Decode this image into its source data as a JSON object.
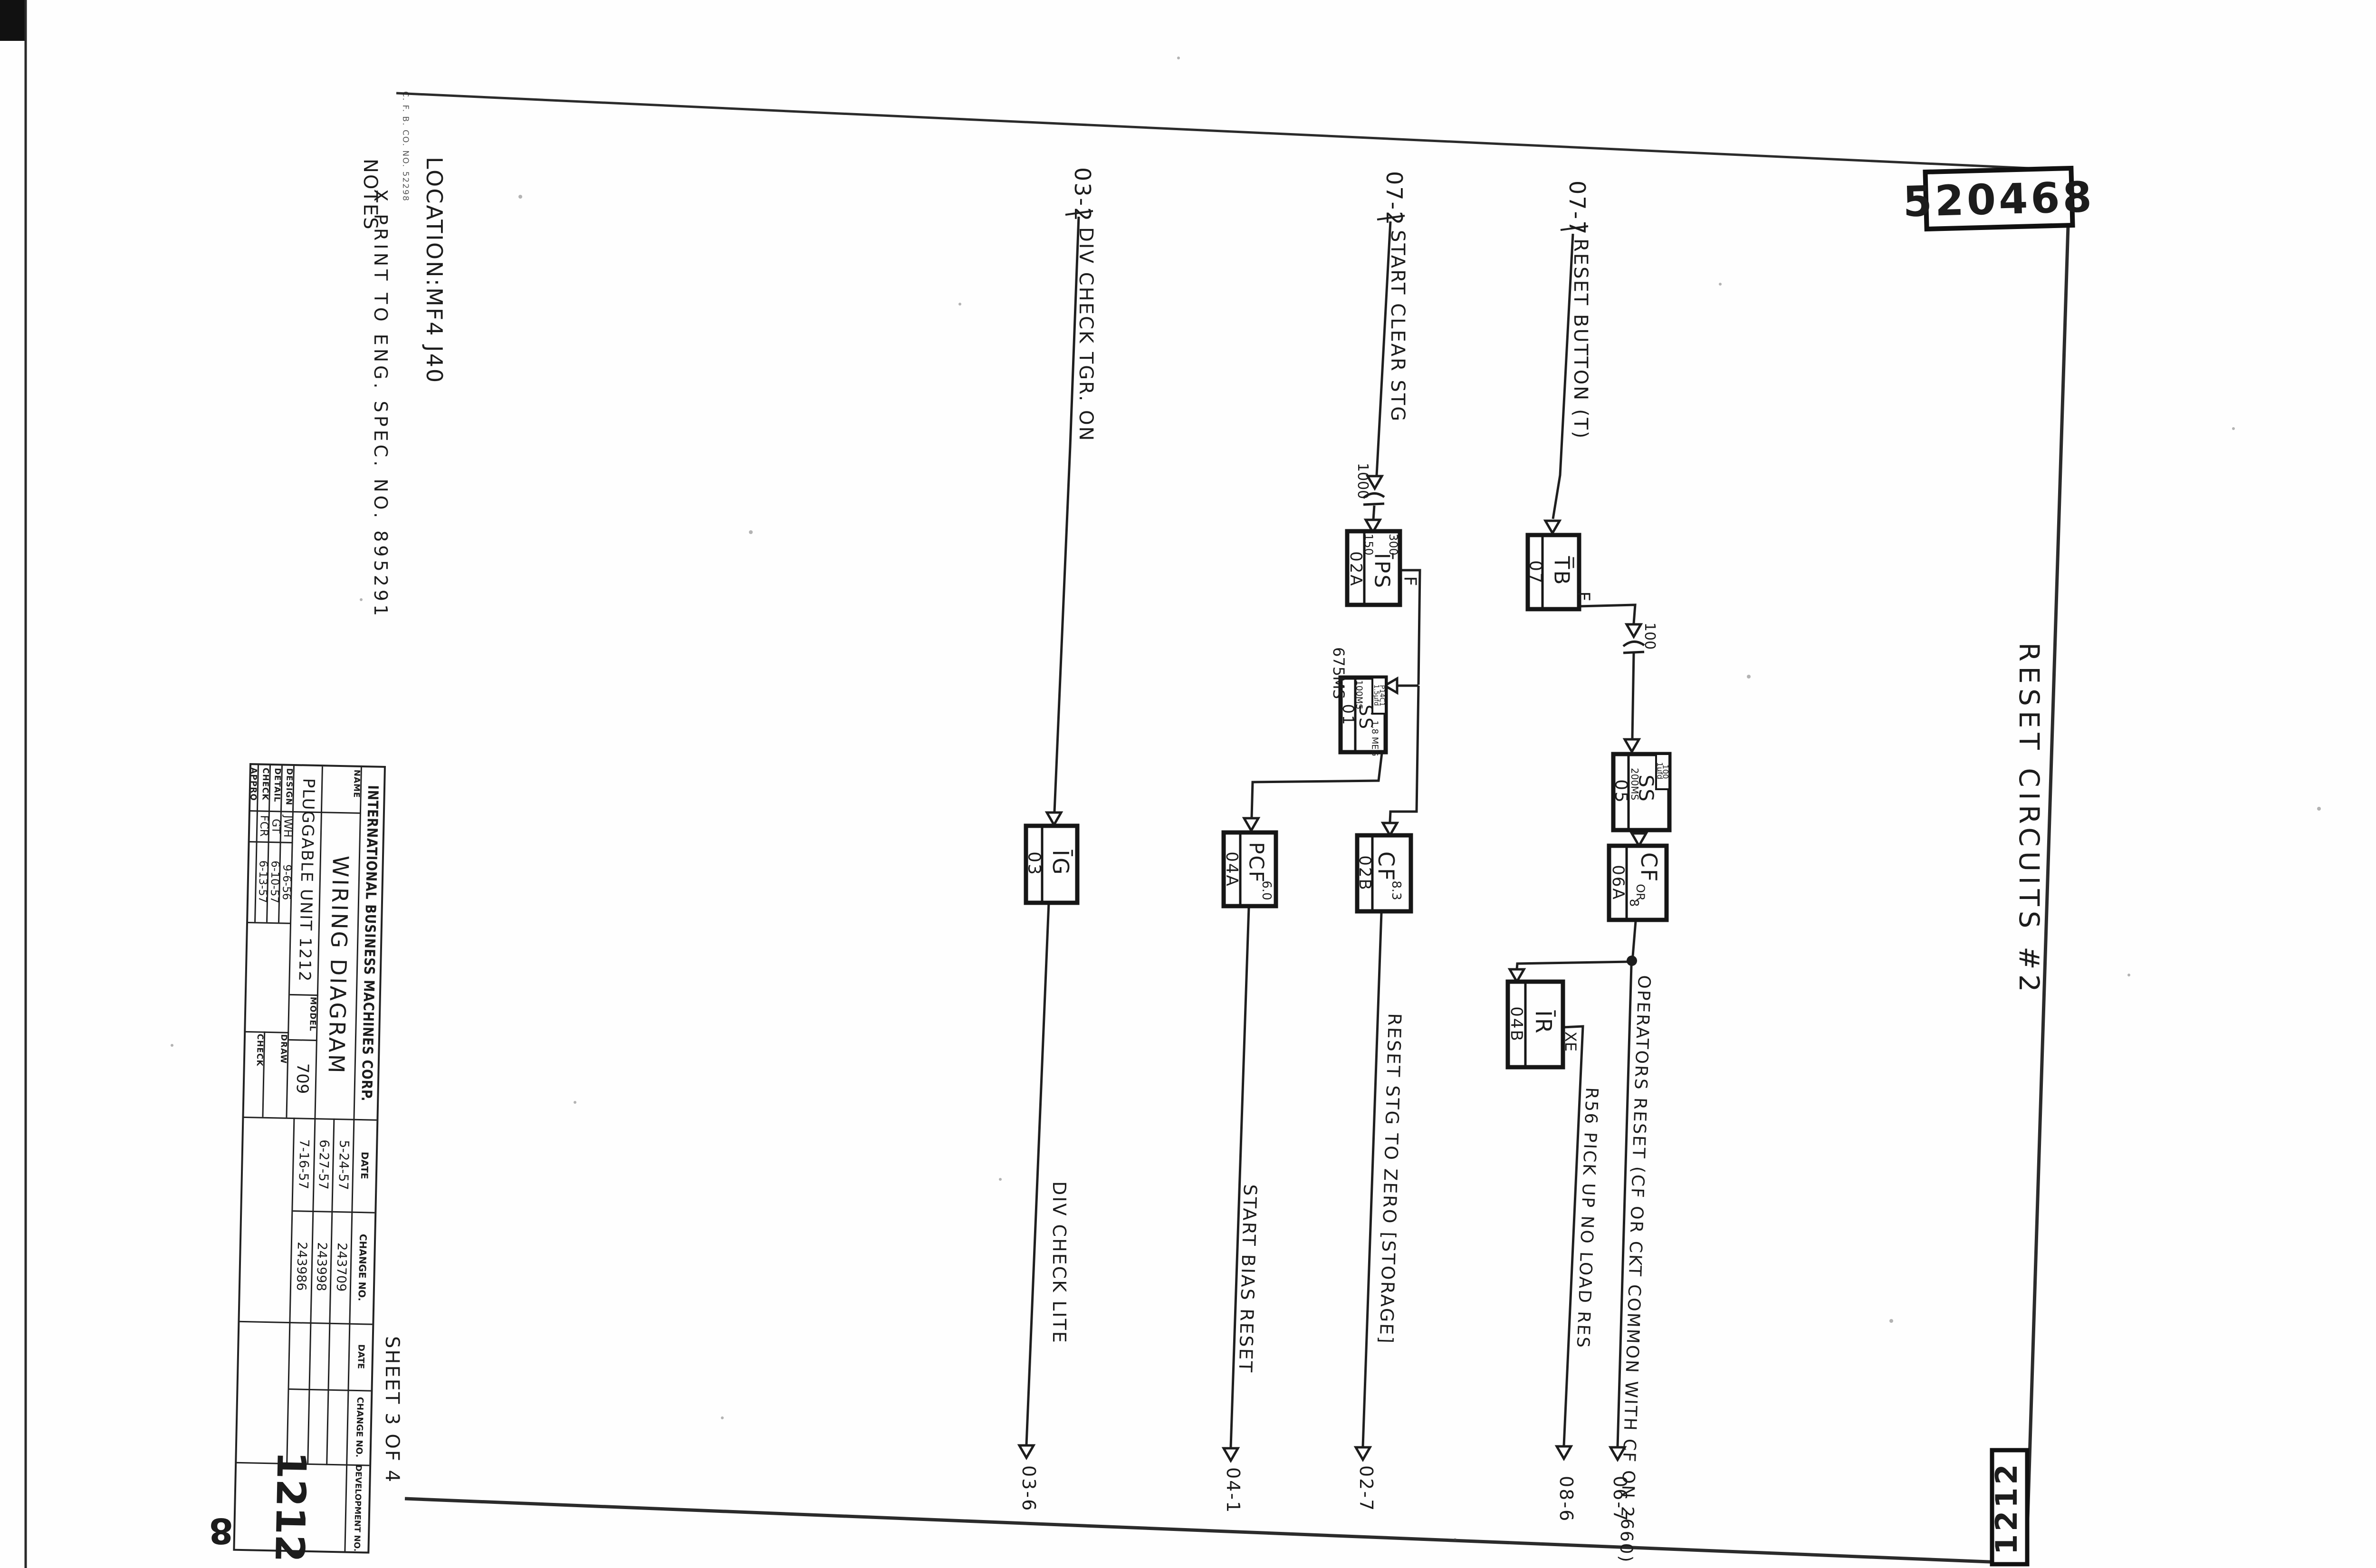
{
  "colors": {
    "ink": "#1c1c1c",
    "paper": "#fefefe"
  },
  "corner": {
    "drawing_no_top": "520468",
    "drawing_no_side": "520468",
    "unit_box": "1212"
  },
  "header": {
    "title": "RESET  CIRCUITS  #2",
    "location": "LOCATION:MF4 J40",
    "notes_heading": "NOTES",
    "note": "X  PRINT TO ENG. SPEC. NO. 895291",
    "fine_print": "C. F. B. CO. NO. 52298",
    "sheet": "SHEET 3 OF 4"
  },
  "title_block": {
    "company": "INTERNATIONAL BUSINESS MACHINES CORP.",
    "name_label": "NAME",
    "name_line1": "WIRING DIAGRAM",
    "name_line2": "PLUGGABLE UNIT 1212",
    "model_label": "MODEL",
    "model_value": "709",
    "rows": [
      {
        "label": "DESIGN",
        "initials": "JWH",
        "date": "9-6-56"
      },
      {
        "label": "DETAIL",
        "initials": "GT",
        "date": "6-10-57"
      },
      {
        "label": "CHECK",
        "initials": "FCR",
        "date": "6-13-57"
      },
      {
        "label": "APPRO",
        "initials": "",
        "date": ""
      }
    ],
    "draw_label": "DRAW",
    "check_label": "CHECK",
    "date_header": "DATE",
    "change_header": "CHANGE NO.",
    "changes": [
      {
        "date": "5-24-57",
        "no": "243709"
      },
      {
        "date": "6-27-57",
        "no": "243998"
      },
      {
        "date": "7-16-57",
        "no": "243986"
      }
    ],
    "development_header": "DEVELOPMENT NO.",
    "development_no": "1212"
  },
  "sources": {
    "s1": {
      "ref": "03-2",
      "name": "DIV CHECK TGR. ON"
    },
    "s2": {
      "ref": "07-2",
      "name": "START CLEAR STG"
    },
    "s3": {
      "ref": "07-7",
      "name": "RESET BUTTON (T)"
    }
  },
  "components": {
    "cap1": "1000",
    "cap2": "100",
    "delay": "675MS",
    "ig": {
      "type": "ĪG",
      "loc": "03"
    },
    "ips": {
      "type": "ĪPS",
      "loc": "02A",
      "r1": "300",
      "r2": "150",
      "out": "F"
    },
    "tb": {
      "type": "T̅B",
      "loc": "07",
      "out": "F"
    },
    "ss1": {
      "type": "SS",
      "loc": "01",
      "t1": "100MS",
      "t2": "1.8 MEG",
      "c1": "1.5μfd",
      "c2": "P14C1"
    },
    "ss2": {
      "type": "SS",
      "loc": "05",
      "t1": "200MS",
      "c1": "1μfd",
      "c2": "100"
    },
    "pcf": {
      "type": "PCF",
      "val": "6.0",
      "loc": "04A"
    },
    "cf1": {
      "type": "CF",
      "val": "8.3",
      "loc": "02B"
    },
    "cf2": {
      "type": "CF",
      "val1": "OR",
      "val2": "8",
      "loc": "06A"
    },
    "ir": {
      "type": "ĪR",
      "loc": "04B",
      "out": "XE"
    }
  },
  "outputs": {
    "o1": {
      "name": "DIV CHECK LITE",
      "dest": "03-6"
    },
    "o2": {
      "name": "START BIAS RESET",
      "dest": "04-1"
    },
    "o3": {
      "name": "RESET STG TO ZERO [STORAGE]",
      "dest": "02-7"
    },
    "o4": {
      "name": "R56 PICK UP NO LOAD RES",
      "dest": "08-6"
    },
    "o5": {
      "name": "OPERATORS RESET (CF OR CKT COMMON WITH CF ON 2660)",
      "dest": "06-7"
    }
  }
}
